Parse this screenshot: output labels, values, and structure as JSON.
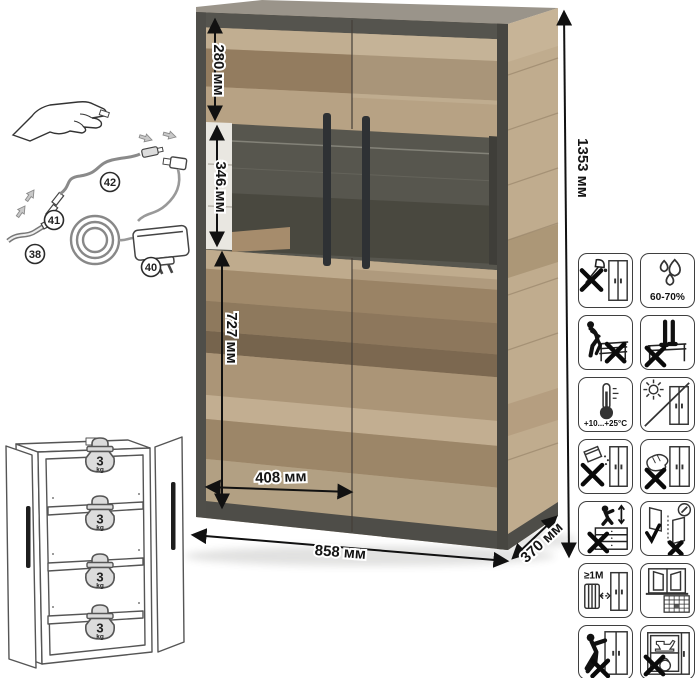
{
  "dimensions": {
    "top_section": "280 мм",
    "display_section": "346 мм",
    "bottom_section": "727 мм",
    "door_width": "408 мм",
    "width": "858 мм",
    "depth": "370 мм",
    "height": "1353 мм"
  },
  "led_kit": {
    "callouts": {
      "led_strip": "38",
      "power_adapter": "40",
      "connector": "41",
      "cable": "42"
    }
  },
  "shelf_limits": [
    {
      "value": "3",
      "unit": "kg"
    },
    {
      "value": "3",
      "unit": "kg"
    },
    {
      "value": "3",
      "unit": "kg"
    },
    {
      "value": "3",
      "unit": "kg"
    }
  ],
  "care_icons": [
    {
      "name": "no-sharp-tools"
    },
    {
      "name": "humidity-range",
      "label": "60-70%"
    },
    {
      "name": "no-sitting"
    },
    {
      "name": "no-standing"
    },
    {
      "name": "temperature-range",
      "label": "+10...+25°C"
    },
    {
      "name": "no-direct-sunlight"
    },
    {
      "name": "no-spilling-liquids"
    },
    {
      "name": "no-wet-cleaning"
    },
    {
      "name": "no-climbing"
    },
    {
      "name": "door-adjustment"
    },
    {
      "name": "heater-distance",
      "label": "≥1M"
    },
    {
      "name": "acclimatization-window-calendar"
    },
    {
      "name": "no-dragging"
    },
    {
      "name": "no-overloading"
    }
  ],
  "colors": {
    "wood": "#b29b7d",
    "wood_light": "#c1ae91",
    "wood_dark": "#8e795d",
    "frame_dark": "#4e4d48",
    "glass_back": "#57564e",
    "handle": "#2e3134",
    "dimension": "#111111"
  }
}
